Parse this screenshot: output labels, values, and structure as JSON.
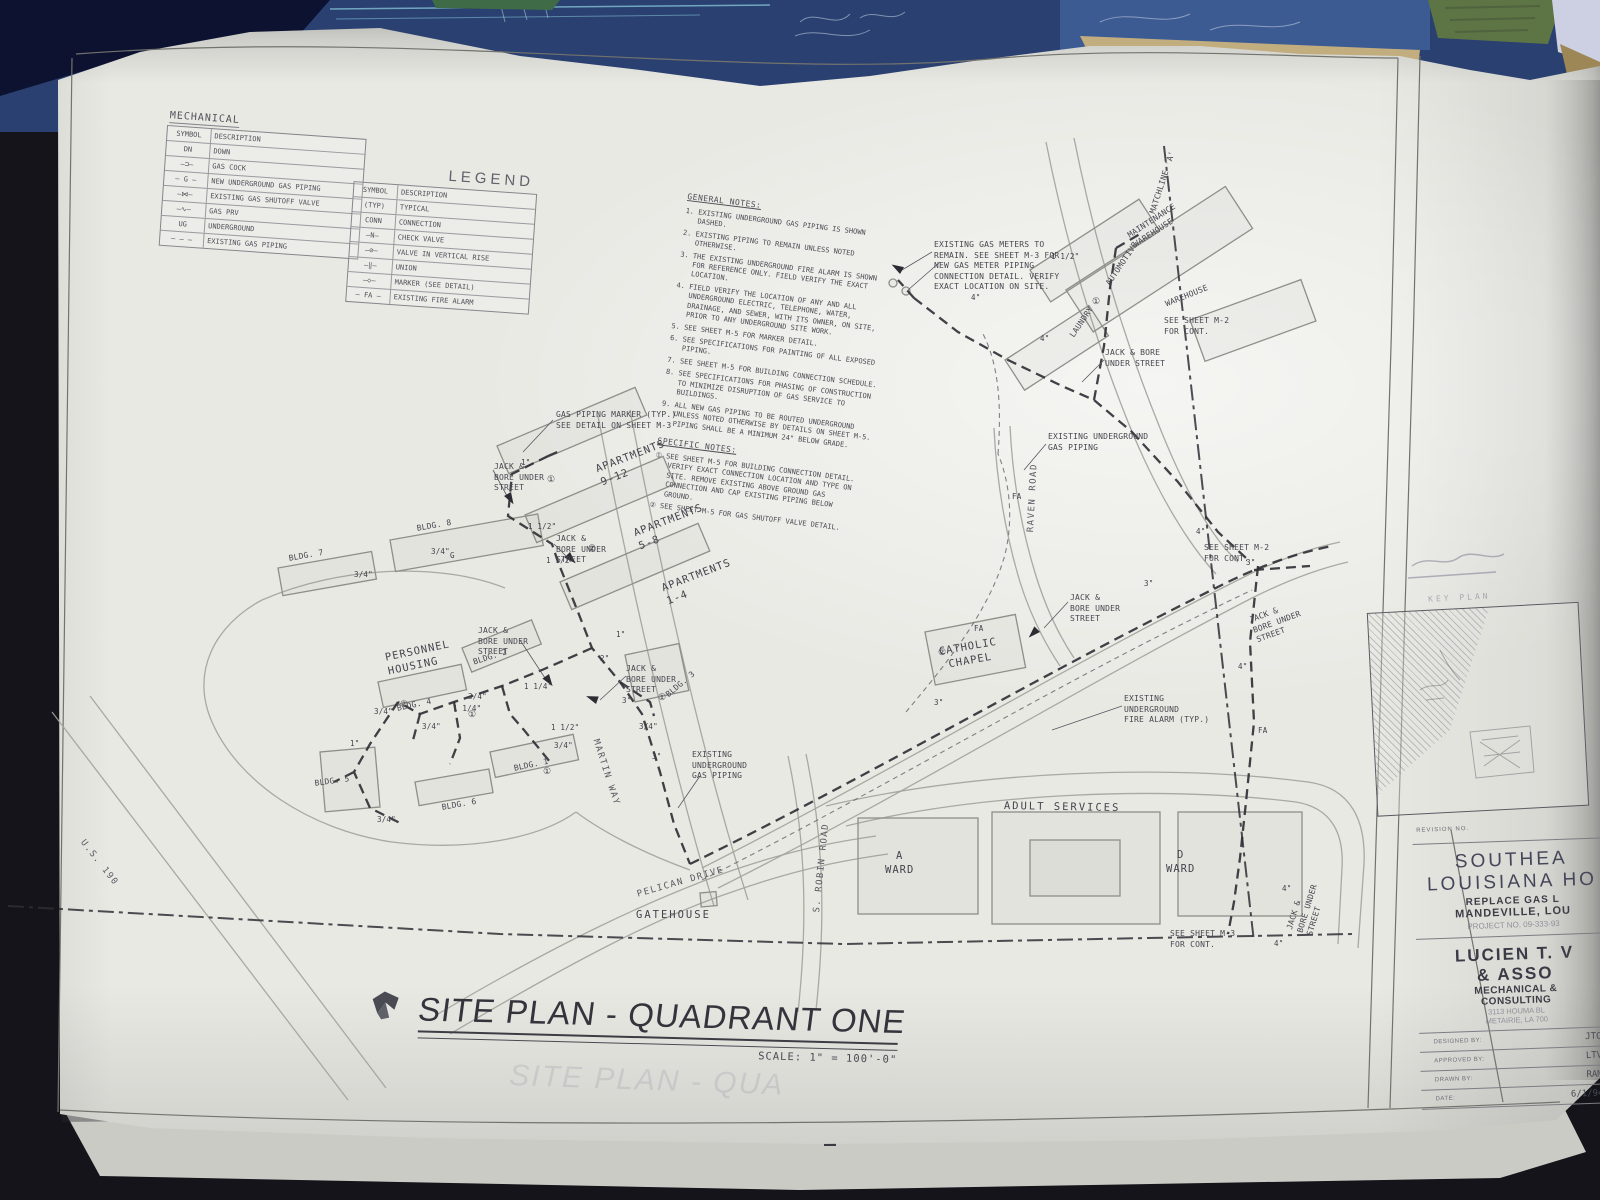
{
  "legend": {
    "title": "MECHANICAL",
    "caption": "LEGEND",
    "col_symbol": "SYMBOL",
    "col_desc": "DESCRIPTION",
    "left_rows": [
      {
        "sym": "DN",
        "desc": "DOWN"
      },
      {
        "sym": "—⊐—",
        "desc": "GAS COCK"
      },
      {
        "sym": "— G —",
        "desc": "NEW UNDERGROUND GAS PIPING"
      },
      {
        "sym": "—⋈—",
        "desc": "EXISTING GAS SHUTOFF VALVE"
      },
      {
        "sym": "—∿—",
        "desc": "GAS PRV"
      },
      {
        "sym": "UG",
        "desc": "UNDERGROUND"
      },
      {
        "sym": "— — —",
        "desc": "EXISTING GAS PIPING"
      }
    ],
    "right_rows": [
      {
        "sym": "(TYP)",
        "desc": "TYPICAL"
      },
      {
        "sym": "CONN",
        "desc": "CONNECTION"
      },
      {
        "sym": "—Ν—",
        "desc": "CHECK VALVE"
      },
      {
        "sym": "—⊘—",
        "desc": "VALVE IN VERTICAL RISE"
      },
      {
        "sym": "—‖—",
        "desc": "UNION"
      },
      {
        "sym": "—◇—",
        "desc": "MARKER (SEE DETAIL)"
      },
      {
        "sym": "— FA —",
        "desc": "EXISTING FIRE ALARM"
      }
    ]
  },
  "notes": {
    "general_title": "GENERAL NOTES:",
    "general": [
      "1.  EXISTING UNDERGROUND GAS PIPING IS SHOWN DASHED.",
      "2.  EXISTING PIPING TO REMAIN UNLESS NOTED OTHERWISE.",
      "3.  THE EXISTING UNDERGROUND FIRE ALARM IS SHOWN FOR REFERENCE ONLY.  FIELD VERIFY THE EXACT LOCATION.",
      "4.  FIELD VERIFY THE LOCATION OF ANY AND ALL UNDERGROUND ELECTRIC, TELEPHONE, WATER, DRAINAGE, AND SEWER, WITH ITS OWNER, ON SITE, PRIOR TO ANY UNDERGROUND SITE WORK.",
      "5.  SEE SHEET M-5 FOR MARKER DETAIL.",
      "6.  SEE SPECIFICATIONS FOR PAINTING OF ALL EXPOSED PIPING.",
      "7.  SEE SHEET M-5 FOR BUILDING CONNECTION SCHEDULE.",
      "8.  SEE SPECIFICATIONS FOR PHASING OF CONSTRUCTION TO MINIMIZE DISRUPTION OF GAS SERVICE TO BUILDINGS.",
      "9.  ALL NEW GAS PIPING TO BE ROUTED UNDERGROUND UNLESS NOTED OTHERWISE BY DETAILS ON SHEET M-5.  PIPING SHALL BE A MINIMUM 24\" BELOW GRADE."
    ],
    "specific_title": "SPECIFIC NOTES:",
    "specific": [
      "①  SEE SHEET M-5 FOR BUILDING CONNECTION DETAIL. VERIFY EXACT CONNECTION LOCATION AND TYPE ON SITE.  REMOVE EXISTING ABOVE GROUND GAS CONNECTION AND CAP EXISTING PIPING BELOW GROUND.",
      "②  SEE SHEET M-5 FOR GAS SHUTOFF VALVE DETAIL."
    ]
  },
  "titlebar": {
    "title": "SITE PLAN - QUADRANT ONE",
    "scale": "SCALE: 1\" = 100'-0\""
  },
  "ghost_title": "SITE PLAN - QUA",
  "titleblock": {
    "revision_label": "REVISION NO.",
    "proj1": "SOUTHEA",
    "proj2": "LOUISIANA HO",
    "proj3": "REPLACE GAS L",
    "proj4": "MANDEVILLE, LOU",
    "proj5": "PROJECT NO. 09-333-93",
    "firm1": "LUCIEN T. V",
    "firm2": "& ASSO",
    "firm3": "MECHANICAL &",
    "firm4": "CONSULTING",
    "firm5": "3113 HOUMA BL",
    "firm6": "METAIRIE, LA 700",
    "f1_label": "DESIGNED BY:",
    "f1_value": "JTC",
    "f2_label": "APPROVED BY:",
    "f2_value": "LTV",
    "f3_label": "DRAWN BY:",
    "f3_value": "RAM",
    "f4_label": "DATE:",
    "f4_value": "6/1/94",
    "key_plan_label": "KEY PLAN"
  },
  "plan": {
    "apartments_9_12": "APARTMENTS\n9-12",
    "apartments_5_8": "APARTMENTS\n5-8",
    "apartments_1_4": "APARTMENTS\n1-4",
    "personnel_housing": "PERSONNEL\nHOUSING",
    "bldg1": "BLDG. 1",
    "bldg2": "BLDG. 2",
    "bldg3": "BLDG. 3",
    "bldg4": "BLDG. 4",
    "bldg5": "BLDG. 5",
    "bldg6": "BLDG. 6",
    "bldg7": "BLDG. 7",
    "bldg8": "BLDG. 8",
    "catholic_chapel": "CATHOLIC\nCHAPEL",
    "adult_services": "ADULT SERVICES",
    "a_ward": "A\nWARD",
    "d_ward": "D\nWARD",
    "gatehouse": "GATEHOUSE",
    "pelican_drive": "PELICAN  DRIVE",
    "martin_way": "MARTIN WAY",
    "s_robin_road": "S. ROBIN ROAD",
    "raven_road": "RAVEN ROAD",
    "us_190": "U.S. 190",
    "maintenance_warehouse": "MAINTENANCE\nWAREHOUSE",
    "automotive": "AUTOMOTIVE",
    "laundry": "LAUNDRY",
    "warehouse": "WAREHOUSE",
    "matchline": "MATCHLINE 'A'"
  },
  "callouts": {
    "gas_marker": "GAS PIPING MARKER (TYP.)\nSEE DETAIL ON SHEET M-3",
    "jack_bore": "JACK &\nBORE UNDER\nSTREET",
    "jack_bore_2": "JACK & BORE\nUNDER STREET",
    "exist_gas": "EXISTING\nUNDERGROUND\nGAS PIPING",
    "exist_gas_2": "EXISTING UNDERGROUND\nGAS PIPING",
    "exist_fa": "EXISTING\nUNDERGROUND\nFIRE ALARM (TYP.)",
    "gas_meters": "EXISTING GAS METERS TO\nREMAIN.  SEE SHEET M-3 FOR\nNEW GAS METER PIPING\nCONNECTION DETAIL.  VERIFY\nEXACT LOCATION ON SITE.",
    "cont_m2": "SEE SHEET M-2\nFOR CONT.",
    "cont_m3": "SEE SHEET M-3\nFOR CONT."
  },
  "sizes": {
    "s1": "1\"",
    "s114": "1 1/4\"",
    "s112": "1 1/2\"",
    "s34": "3/4\"",
    "s2": "2\"",
    "s3": "3\"",
    "s4": "4\"",
    "fa": "FA",
    "g": "G"
  },
  "tags": {
    "t1": "①",
    "t2": "②"
  }
}
